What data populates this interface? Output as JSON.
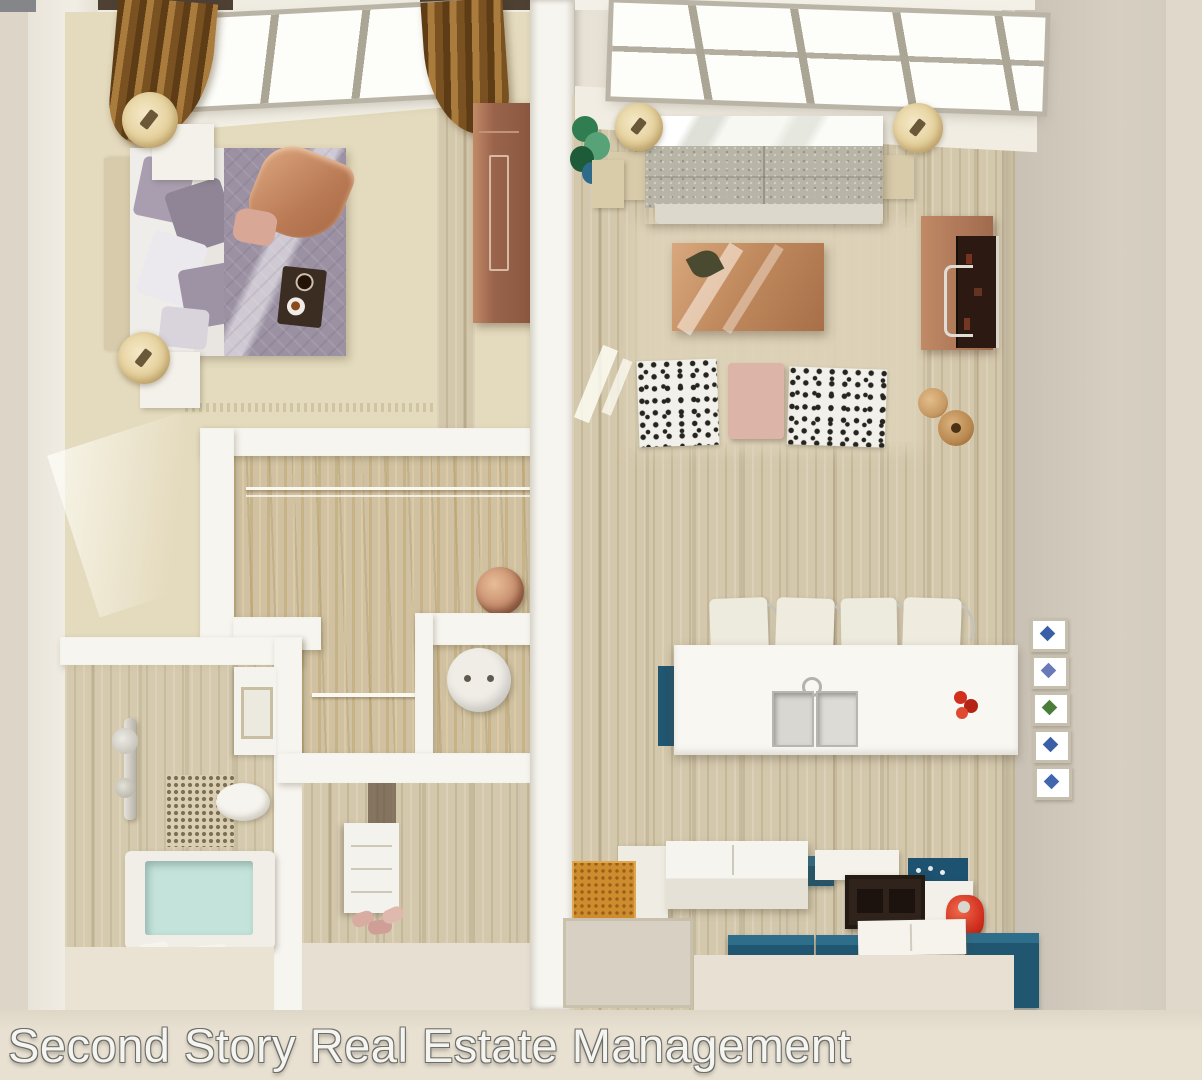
{
  "watermark": {
    "text": "Second Story Real Estate Management"
  },
  "colors": {
    "bg_outer": "#e8e2d6",
    "wall_white": "#f7f5ef",
    "wall_shadow": "#d8d2c4",
    "bedroom_carpet": "#e4dabd",
    "wood_base": "#d4c8ac",
    "closet_floor": "#cfc1a1",
    "curtain_dark": "#6e4a1e",
    "window_white": "#fdfdf9",
    "mullion": "#aba595",
    "wardrobe_copper": "#9a644c",
    "bed_duvet": "#9b91a3",
    "bed_throw": "#c89070",
    "sofa_gray": "#b8b5a6",
    "table_copper": "#c08a5e",
    "tv_screen": "#2c1a12",
    "chair_white": "#f2f0ea",
    "ottoman_pink": "#dcb5a8",
    "teal": "#20566f",
    "dark_unit": "#2f231c",
    "red_accent": "#d2301e",
    "tub_water": "#c4e3db",
    "orange_mat": "#cf8c2e",
    "watermark": "#f4f4f1"
  },
  "tiles": {
    "colors": [
      "#3b5fa6",
      "#6a79b8",
      "#4a7d38",
      "#3b5fa6",
      "#4066ae"
    ]
  }
}
